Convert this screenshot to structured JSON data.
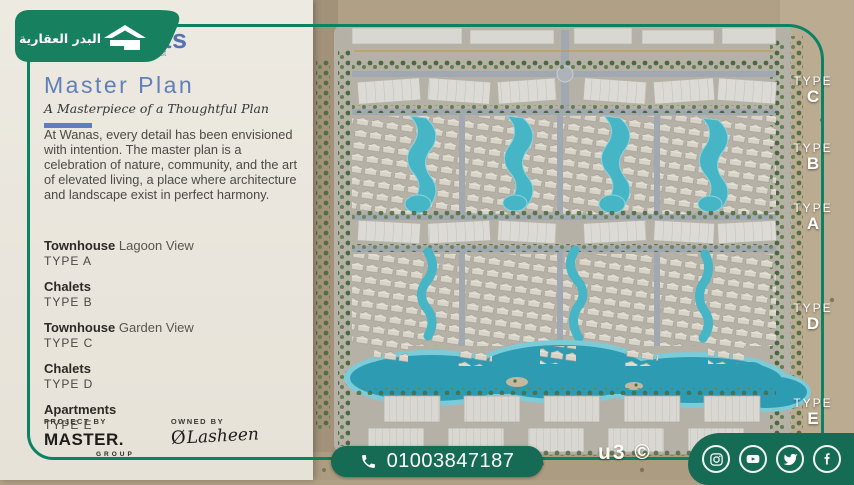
{
  "brand": {
    "badge_text_ar": "البدر العقارية",
    "logo_fragment": "as",
    "logo_sub_fragment": "st"
  },
  "panel": {
    "title": "Master Plan",
    "subtitle": "A Masterpiece of a Thoughtful Plan",
    "description": "At Wanas, every detail has been envisioned with intention. The master plan is a celebration of nature, community, and the art of elevated living, a place where architecture and landscape exist in perfect harmony.",
    "units": [
      {
        "name": "Townhouse",
        "suffix": " Lagoon View",
        "type": "TYPE A"
      },
      {
        "name": "Chalets",
        "suffix": "",
        "type": "TYPE B"
      },
      {
        "name": "Townhouse",
        "suffix": " Garden View",
        "type": "TYPE C"
      },
      {
        "name": "Chalets",
        "suffix": "",
        "type": "TYPE D"
      },
      {
        "name": "Apartments",
        "suffix": "",
        "type": "TYPE E"
      }
    ],
    "project_by_label": "PROJECT BY",
    "project_by_name": "MASTER.",
    "project_by_sub": "GROUP",
    "owned_by_label": "OWNED BY",
    "owned_by_monogram": "Ø",
    "owned_by_name": "Lasheen"
  },
  "map": {
    "type_labels": [
      {
        "word": "TYPE",
        "letter": "C"
      },
      {
        "word": "TYPE",
        "letter": "B"
      },
      {
        "word": "TYPE",
        "letter": "A"
      },
      {
        "word": "TYPE",
        "letter": "D"
      },
      {
        "word": "TYPE",
        "letter": "E"
      }
    ],
    "watermark": "u3 ©"
  },
  "contact": {
    "phone": "01003847187"
  },
  "social": {
    "items": [
      "instagram",
      "youtube",
      "twitter",
      "facebook"
    ]
  },
  "colors": {
    "brand_green": "#166b54",
    "line_green": "#0c8265",
    "heading_blue": "#6080b8",
    "accent_blue": "#5b7fc0",
    "lagoon": "#3fb0c4",
    "panel_bg": "#e9e5dc"
  }
}
